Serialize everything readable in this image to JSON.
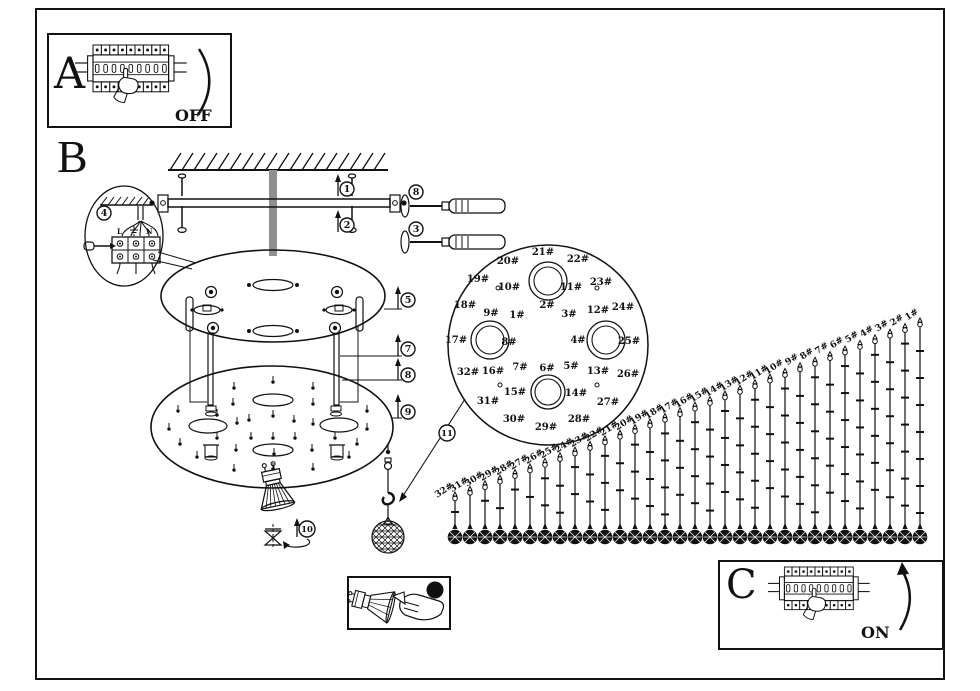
{
  "sheet": {
    "bg": "#ffffff",
    "ink": "#111111"
  },
  "panel_a": {
    "letter": "A",
    "status_label": "OFF"
  },
  "panel_b": {
    "letter": "B"
  },
  "panel_c": {
    "letter": "C",
    "status_label": "ON"
  },
  "bulb_box": {
    "callout": "10"
  },
  "wiring": {
    "live": "L",
    "neutral": "N"
  },
  "callouts": [
    {
      "n": "1",
      "x": 347,
      "y": 189
    },
    {
      "n": "2",
      "x": 347,
      "y": 225
    },
    {
      "n": "8",
      "x": 416,
      "y": 192
    },
    {
      "n": "3",
      "x": 416,
      "y": 229
    },
    {
      "n": "4",
      "x": 104,
      "y": 213
    },
    {
      "n": "5",
      "x": 408,
      "y": 300
    },
    {
      "n": "7",
      "x": 408,
      "y": 349
    },
    {
      "n": "8",
      "x": 408,
      "y": 375
    },
    {
      "n": "9",
      "x": 408,
      "y": 412
    },
    {
      "n": "10",
      "x": 307,
      "y": 529
    },
    {
      "n": "11",
      "x": 447,
      "y": 433
    }
  ],
  "detail_plate": {
    "hole_labels": [
      {
        "t": "1#",
        "x": 517,
        "y": 318
      },
      {
        "t": "2#",
        "x": 547,
        "y": 308
      },
      {
        "t": "3#",
        "x": 569,
        "y": 317
      },
      {
        "t": "4#",
        "x": 578,
        "y": 343
      },
      {
        "t": "5#",
        "x": 571,
        "y": 369
      },
      {
        "t": "6#",
        "x": 547,
        "y": 371
      },
      {
        "t": "7#",
        "x": 520,
        "y": 370
      },
      {
        "t": "8#",
        "x": 509,
        "y": 345
      },
      {
        "t": "9#",
        "x": 491,
        "y": 316
      },
      {
        "t": "10#",
        "x": 509,
        "y": 290
      },
      {
        "t": "11#",
        "x": 571,
        "y": 290
      },
      {
        "t": "12#",
        "x": 598,
        "y": 313
      },
      {
        "t": "13#",
        "x": 598,
        "y": 374
      },
      {
        "t": "14#",
        "x": 576,
        "y": 396
      },
      {
        "t": "15#",
        "x": 515,
        "y": 395
      },
      {
        "t": "16#",
        "x": 493,
        "y": 374
      },
      {
        "t": "17#",
        "x": 456,
        "y": 343
      },
      {
        "t": "18#",
        "x": 465,
        "y": 308
      },
      {
        "t": "19#",
        "x": 478,
        "y": 282
      },
      {
        "t": "20#",
        "x": 508,
        "y": 264
      },
      {
        "t": "21#",
        "x": 543,
        "y": 255
      },
      {
        "t": "22#",
        "x": 578,
        "y": 262
      },
      {
        "t": "23#",
        "x": 601,
        "y": 285
      },
      {
        "t": "24#",
        "x": 623,
        "y": 310
      },
      {
        "t": "25#",
        "x": 629,
        "y": 344
      },
      {
        "t": "26#",
        "x": 628,
        "y": 377
      },
      {
        "t": "27#",
        "x": 608,
        "y": 405
      },
      {
        "t": "28#",
        "x": 579,
        "y": 422
      },
      {
        "t": "29#",
        "x": 546,
        "y": 430
      },
      {
        "t": "30#",
        "x": 514,
        "y": 422
      },
      {
        "t": "31#",
        "x": 488,
        "y": 404
      },
      {
        "t": "32#",
        "x": 468,
        "y": 375
      }
    ]
  },
  "strands": {
    "labels": [
      "32#",
      "31#",
      "30#",
      "29#",
      "28#",
      "27#",
      "26#",
      "25#",
      "24#",
      "23#",
      "22#",
      "21#",
      "20#",
      "19#",
      "18#",
      "17#",
      "16#",
      "15#",
      "14#",
      "13#",
      "12#",
      "11#",
      "10#",
      "9#",
      "8#",
      "7#",
      "6#",
      "5#",
      "4#",
      "3#",
      "2#",
      "1#"
    ]
  }
}
